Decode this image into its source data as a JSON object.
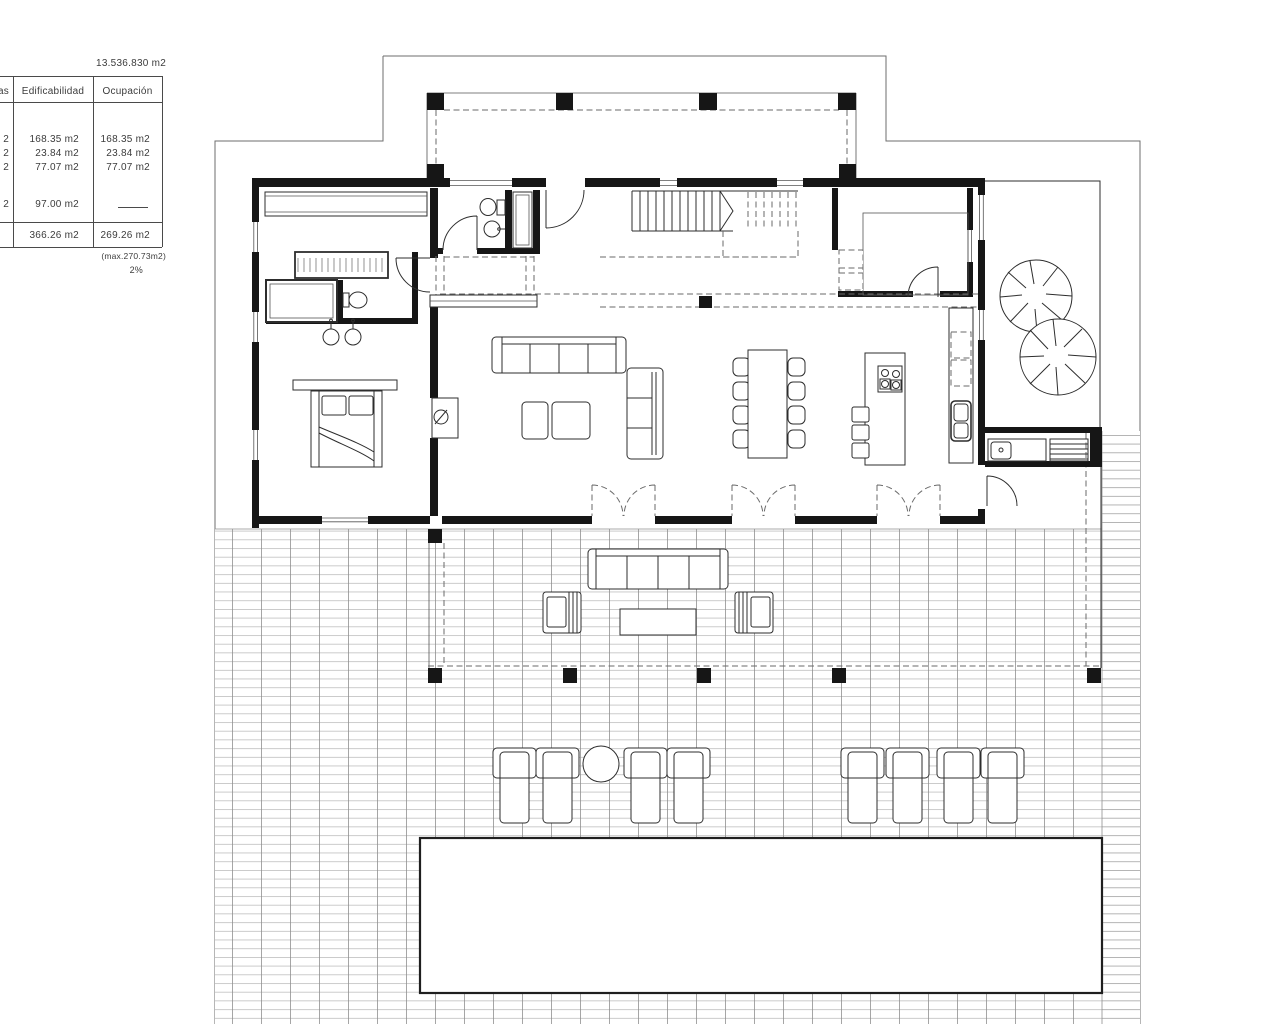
{
  "header": {
    "parcel_area": "13.536.830 m2"
  },
  "table": {
    "headers": [
      "as",
      "Edificabilidad",
      "Ocupación"
    ],
    "rows": [
      {
        "c1": "2",
        "edificabilidad": "168.35 m2",
        "ocupacion": "168.35 m2"
      },
      {
        "c1": "2",
        "edificabilidad": "23.84 m2",
        "ocupacion": "23.84 m2"
      },
      {
        "c1": "2",
        "edificabilidad": "77.07 m2",
        "ocupacion": "77.07 m2"
      },
      {
        "c1": "2",
        "edificabilidad": "97.00 m2",
        "ocupacion": ""
      },
      {
        "c1": "",
        "edificabilidad": "366.26 m2",
        "ocupacion": "269.26 m2"
      }
    ],
    "footnote_max": "(max.270.73m2)",
    "footnote_percent": "2%"
  },
  "colors": {
    "wall": "#161616",
    "line": "#2d2d2d",
    "boundary": "#6e6e6e",
    "paving_minor": "#b8b8b8",
    "paving_major": "#8f8f8f",
    "text": "#3c3c3c"
  },
  "plan_features": [
    "property-boundary",
    "upper-floor-overhang",
    "master-bedroom",
    "wardrobes",
    "shower",
    "toilets",
    "double-sinks",
    "guest-bathroom",
    "entry",
    "stairs",
    "laundry-room",
    "living-room-sofas",
    "dining-table-8-chairs",
    "kitchen-island",
    "kitchen-counter-sink",
    "patio-trees",
    "outdoor-kitchen",
    "pergola-terrace",
    "outdoor-lounge-set",
    "sun-loungers",
    "swimming-pool"
  ]
}
